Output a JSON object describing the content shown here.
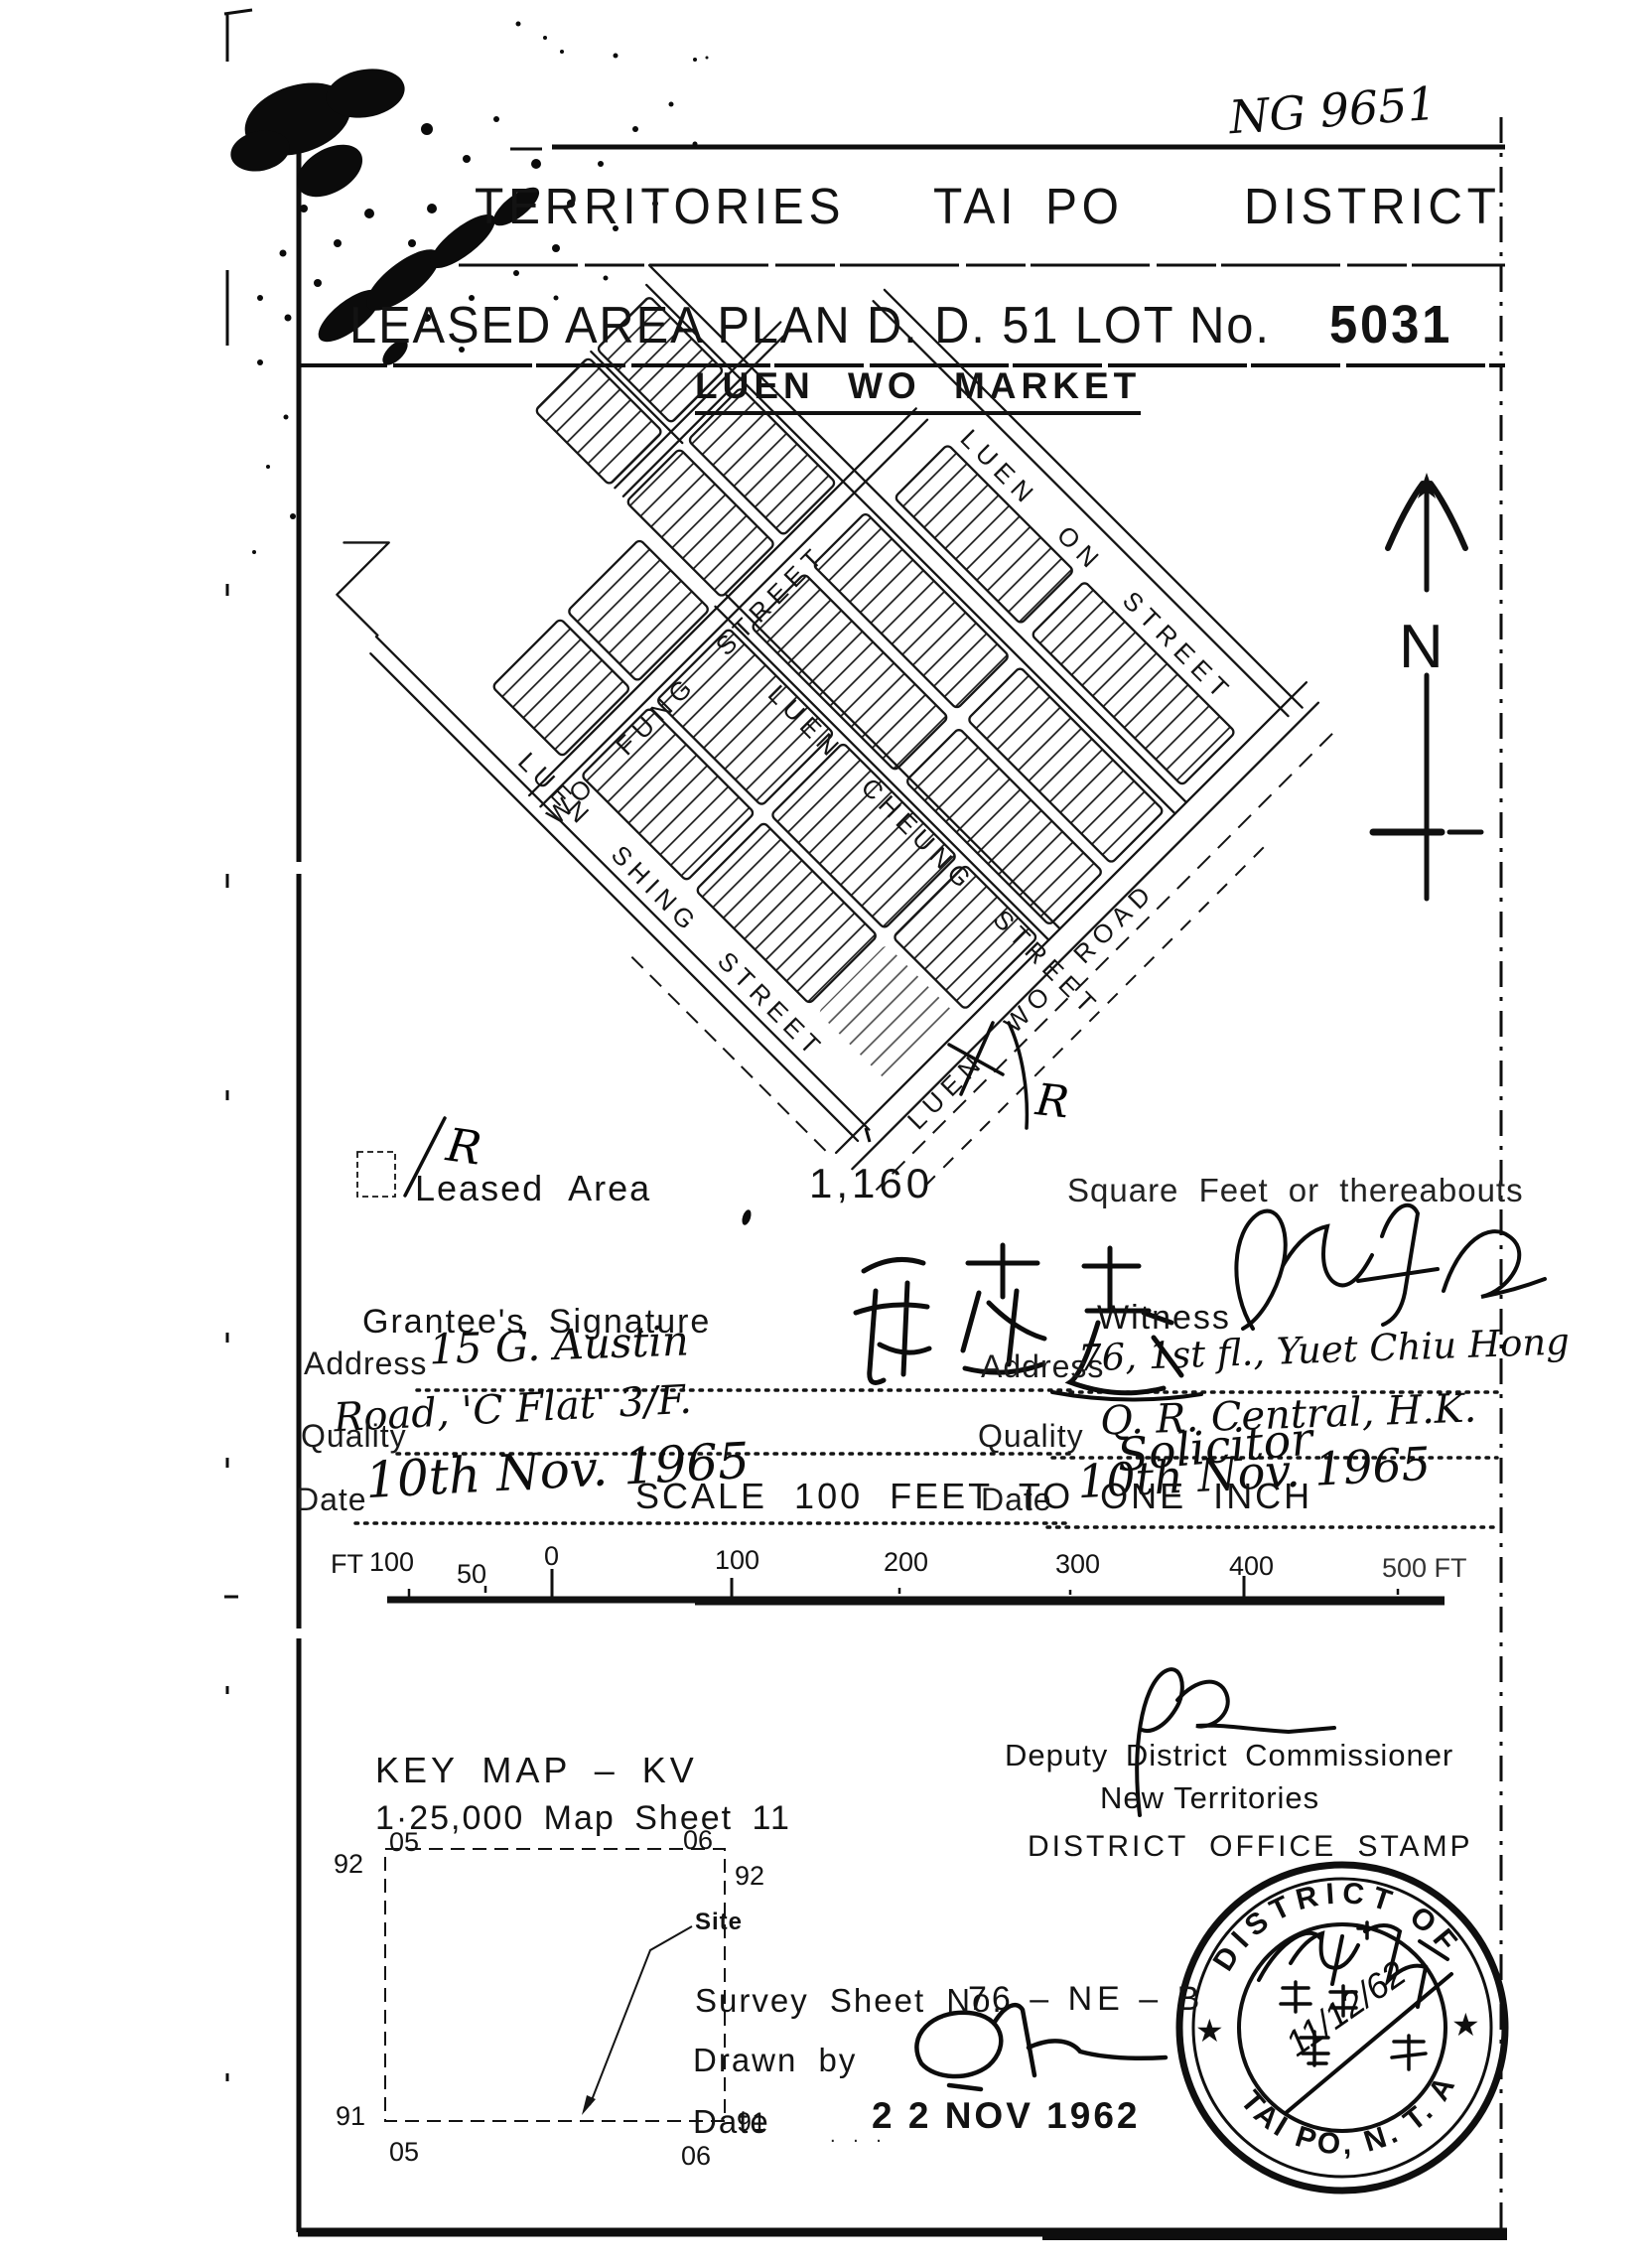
{
  "page": {
    "ref_no": "NG 9651"
  },
  "header": {
    "line1_words": [
      "TERRITORIES",
      "TAI",
      "PO",
      "DISTRICT"
    ],
    "line2": "LEASED AREA PLAN D. D. 51 LOT No.",
    "lot_no": "5031",
    "subtitle": "LUEN WO MARKET"
  },
  "map": {
    "streets": {
      "luen_on": "LUEN ON STREET",
      "wo_fung": "WO FUNG STREET",
      "luen_cheung": "LUEN CHEUNG STREET",
      "luen_shing": "LUEN SHING STREET",
      "luen_wo_road": "LUEN WO ROAD"
    },
    "north_label": "N",
    "hand_mark": "R"
  },
  "legend": {
    "label": "Leased Area",
    "area_value": "1,160",
    "area_units": "Square Feet or thereabouts",
    "annotation": "R"
  },
  "grantee": {
    "section_label": "Grantee's Signature",
    "signature": "chinese-calligraphy-signature",
    "address_label": "Address",
    "address_line1": "15 G. Austin",
    "address_line2": "Road, 'C Flat' 3/F.",
    "quality_label": "Quality",
    "date_label": "Date",
    "date_value": "10th Nov. 1965"
  },
  "witness": {
    "section_label": "Witness",
    "signature": "cursive-signature",
    "address_label": "Address",
    "address_line1": "76, 1st fl., Yuet Chiu Hong",
    "address_line2": "Q. R. Central, H.K.",
    "quality_label": "Quality",
    "quality_value": "Solicitor",
    "date_label": "Date",
    "date_value": "10th Nov. 1965"
  },
  "scale": {
    "title": "SCALE 100 FEET TO ONE INCH",
    "labels": [
      "FT",
      "100",
      "50",
      "0",
      "100",
      "200",
      "300",
      "400",
      "500 FT"
    ]
  },
  "key_map": {
    "title": "KEY MAP – KV",
    "sheet": "1·25,000 Map Sheet 11",
    "grid": {
      "top_left": "05",
      "top_right": "06",
      "row_top": "92",
      "row_bottom": "91",
      "bottom_left": "05",
      "bottom_right": "06"
    },
    "site_label": "Site"
  },
  "survey": {
    "sheet_label": "Survey Sheet No.",
    "sheet_no": "76 – NE – B",
    "drawn_by_label": "Drawn by",
    "date_label": "Date",
    "date_stamp": "2 2 NOV 1962"
  },
  "approval": {
    "title_line1": "Deputy District Commissioner",
    "title_line2": "New Territories",
    "stamp_caption": "DISTRICT OFFICE STAMP"
  },
  "stamp": {
    "top_text": "DISTRICT OF",
    "bottom_text": "TAI PO, N. T. A.",
    "hand_date": "11/12/62",
    "star": "★"
  }
}
